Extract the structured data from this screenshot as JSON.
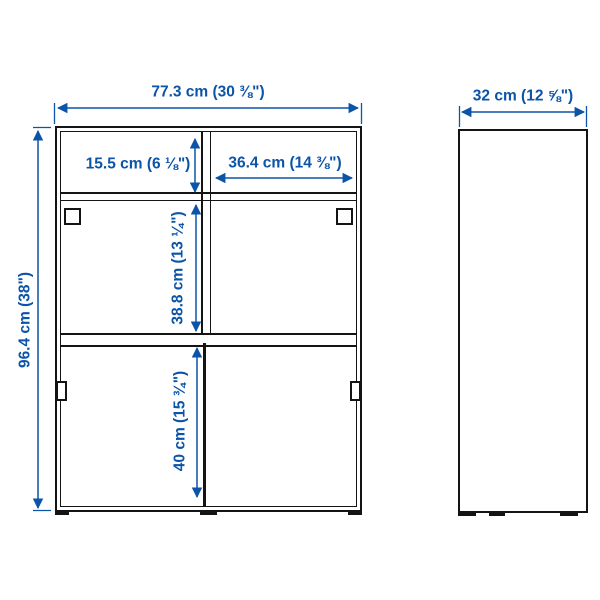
{
  "diagram": {
    "product_views": {
      "front_view": "cabinet front elevation with two sliding-door sections and top shelf",
      "side_view": "cabinet side elevation"
    },
    "labels": {
      "front_width": "77.3 cm (30 ⅜\")",
      "front_height": "96.4 cm (38\")",
      "side_depth": "32 cm (12 ⅝\")",
      "top_shelf_height": "15.5 cm (6 ⅛\")",
      "top_right_width": "36.4 cm (14 ⅜\")",
      "middle_section_height": "38.8 cm (13 ¼\")",
      "bottom_section_height": "40 cm (15 ¾\")"
    },
    "colors": {
      "dimension_blue": "#0b54a8",
      "line_black": "#141414",
      "background": "#ffffff"
    }
  }
}
